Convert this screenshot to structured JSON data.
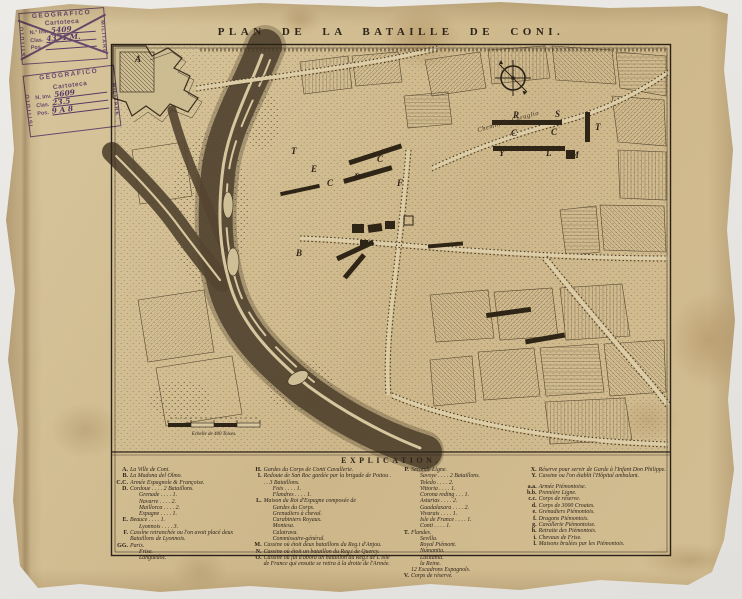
{
  "title": "PLAN DE LA BATAILLE DE CONI.",
  "stamps": [
    {
      "top": "GEOGRAFICO",
      "left_word": "ISTITUTO",
      "right_word": "MILITARE",
      "org": "Cartoteca",
      "rows": [
        {
          "label": "N.° Inv.",
          "value": "5409"
        },
        {
          "label": "Clas.",
          "value": "4371 M."
        },
        {
          "label": "Pos.",
          "value": ""
        }
      ]
    },
    {
      "top": "GEOGRAFICO",
      "left_word": "ISTITUTO",
      "right_word": "MILITARE",
      "org": "Cartoteca",
      "rows": [
        {
          "label": "N. Inv.",
          "value": "5609"
        },
        {
          "label": "Clas.",
          "value": "23.5"
        },
        {
          "label": "Pos.",
          "value": "9 A 8"
        }
      ]
    }
  ],
  "legend": {
    "header": "EXPLICATION.",
    "col1": [
      {
        "k": "A.",
        "t": "La Ville de Coni."
      },
      {
        "k": "B.",
        "t": "La Madona del Olmo."
      },
      {
        "k": "C.C.",
        "t": "Armée Espagnole & Françoise."
      },
      {
        "k": "D.",
        "t": "Cordoue . . . . 2 Bataillons."
      },
      {
        "k": "",
        "t": "Grenade . . . . 1.",
        "ind": 1
      },
      {
        "k": "",
        "t": "Navarre . . . . 2.",
        "ind": 1
      },
      {
        "k": "",
        "t": "Maillorca . . . . 2.",
        "ind": 1
      },
      {
        "k": "",
        "t": "Espagne . . . . 1.",
        "ind": 1
      },
      {
        "k": "E.",
        "t": "Beauce . . . . 1."
      },
      {
        "k": "",
        "t": "Lyonnois . . . . 3.",
        "ind": 1
      },
      {
        "k": "F.",
        "t": "Cassine retranchée ou l'on avoit placé deux Bataillons de Lyonnois."
      },
      {
        "k": "GG.",
        "t": "Paris."
      },
      {
        "k": "",
        "t": "Frise.",
        "ind": 1
      },
      {
        "k": "",
        "t": "Languedoc.",
        "ind": 1
      }
    ],
    "col2": [
      {
        "k": "H.",
        "t": "Gardes du Corps de Conti Cavallerie."
      },
      {
        "k": "I.",
        "t": "Redoute de San Roc gardée par la brigade de Poitou . . . 3 Bataillons."
      },
      {
        "k": "",
        "t": "Foix . . . . 1.",
        "ind": 1
      },
      {
        "k": "",
        "t": "Flandres . . . . 1.",
        "ind": 1
      },
      {
        "k": "L.",
        "t": "Maison du Roi d'Espagne composée de"
      },
      {
        "k": "",
        "t": "Gardes du Corps.",
        "ind": 1
      },
      {
        "k": "",
        "t": "Grenadiers à cheval.",
        "ind": 1
      },
      {
        "k": "",
        "t": "Carabiniers Royaux.",
        "ind": 1
      },
      {
        "k": "",
        "t": "Montesa.",
        "ind": 1
      },
      {
        "k": "",
        "t": "Calatrava.",
        "ind": 1
      },
      {
        "k": "",
        "t": "Commissaire-général.",
        "ind": 1
      },
      {
        "k": "M.",
        "t": "Cassine où étoit deux bataillons du Reg.t d'Anjou."
      },
      {
        "k": "N.",
        "t": "Cassine où étoit un bataillon du Reg.t de Quercy."
      },
      {
        "k": "O.",
        "t": "Cassine où fût d'abord un bataillon du Reg.t de L'Isle de France qui ensuite se retira à la droite de l'Armée."
      }
    ],
    "col3": [
      {
        "k": "P.",
        "t": "Seconde Ligne."
      },
      {
        "k": "",
        "t": "Savoye . . . . 2 Bataillons.",
        "ind": 1
      },
      {
        "k": "",
        "t": "Toledo . . . . 2.",
        "ind": 1
      },
      {
        "k": "",
        "t": "Vittoria . . . . 1.",
        "ind": 1
      },
      {
        "k": "",
        "t": "Corona reding . . . 1.",
        "ind": 1
      },
      {
        "k": "",
        "t": "Asturias . . . . 2.",
        "ind": 1
      },
      {
        "k": "",
        "t": "Guadalaxara . . . . 2.",
        "ind": 1
      },
      {
        "k": "",
        "t": "Vivarais . . . . 1.",
        "ind": 1
      },
      {
        "k": "",
        "t": "Isle de France . . . . 1.",
        "ind": 1
      },
      {
        "k": "",
        "t": "Conti . . . . 1.",
        "ind": 1
      },
      {
        "k": "T.",
        "t": "Flandes."
      },
      {
        "k": "",
        "t": "Sevilla.",
        "ind": 1
      },
      {
        "k": "",
        "t": "Royal Piémont.",
        "ind": 1
      },
      {
        "k": "",
        "t": "Numantia.",
        "ind": 1
      },
      {
        "k": "",
        "t": "Lusitania.",
        "ind": 1
      },
      {
        "k": "",
        "t": "la Reine.",
        "ind": 1
      },
      {
        "k": "",
        "t": "12 Escadrons Espagnols."
      },
      {
        "k": "V.",
        "t": "Corps de réserve."
      }
    ],
    "col4": [
      {
        "k": "X.",
        "t": "Réserve pour servir de Garde à l'Infant Don Philippe."
      },
      {
        "k": "Y.",
        "t": "Cassine ou l'on établit l'Hôpital ambulant."
      },
      {
        "k": "a.a.",
        "t": "Armée Piémontoise.",
        "gap": 1
      },
      {
        "k": "b.b.",
        "t": "Première Ligne."
      },
      {
        "k": "c.c.",
        "t": "Corps de réserve."
      },
      {
        "k": "d.",
        "t": "Corps de 3000 Croates."
      },
      {
        "k": "e.",
        "t": "Grenadiers Piémontois."
      },
      {
        "k": "f.",
        "t": "Dragons Piémontois."
      },
      {
        "k": "g.",
        "t": "Cavallerie Piémontoise."
      },
      {
        "k": "h.",
        "t": "Retraite des Piémontois."
      },
      {
        "k": "i.",
        "t": "Chevaux de Frise."
      },
      {
        "k": "l.",
        "t": "Maisons brulées par les Piémontois."
      }
    ]
  },
  "map": {
    "labels": [
      {
        "char": "A",
        "x": 135,
        "y": 62
      },
      {
        "char": "B",
        "x": 296,
        "y": 256
      },
      {
        "char": "T",
        "x": 291,
        "y": 154
      },
      {
        "char": "C",
        "x": 327,
        "y": 186
      },
      {
        "char": "D",
        "x": 354,
        "y": 180
      },
      {
        "char": "E",
        "x": 311,
        "y": 172
      },
      {
        "char": "C",
        "x": 377,
        "y": 162
      },
      {
        "char": "F",
        "x": 397,
        "y": 186
      },
      {
        "char": "Y",
        "x": 499,
        "y": 156
      },
      {
        "char": "R",
        "x": 513,
        "y": 118
      },
      {
        "char": "S",
        "x": 555,
        "y": 117
      },
      {
        "char": "C",
        "x": 511,
        "y": 136
      },
      {
        "char": "C",
        "x": 551,
        "y": 135
      },
      {
        "char": "T",
        "x": 595,
        "y": 130
      },
      {
        "char": "L",
        "x": 546,
        "y": 156
      },
      {
        "char": "M",
        "x": 571,
        "y": 158
      },
      {
        "text": "Chemin de Caraglio",
        "x": 478,
        "y": 132,
        "rot": -16,
        "cls": "roadlbl",
        "name": "road-label-caraglio"
      },
      {
        "text": "Echelle de 400 Toises.",
        "x": 214,
        "y": 435,
        "cls": "slbl",
        "name": "scale-caption"
      }
    ]
  },
  "colors": {
    "paper": "#d3be93",
    "ink": "#2b2217",
    "river": "#544531",
    "stamp_purple": "#6e52aa"
  }
}
